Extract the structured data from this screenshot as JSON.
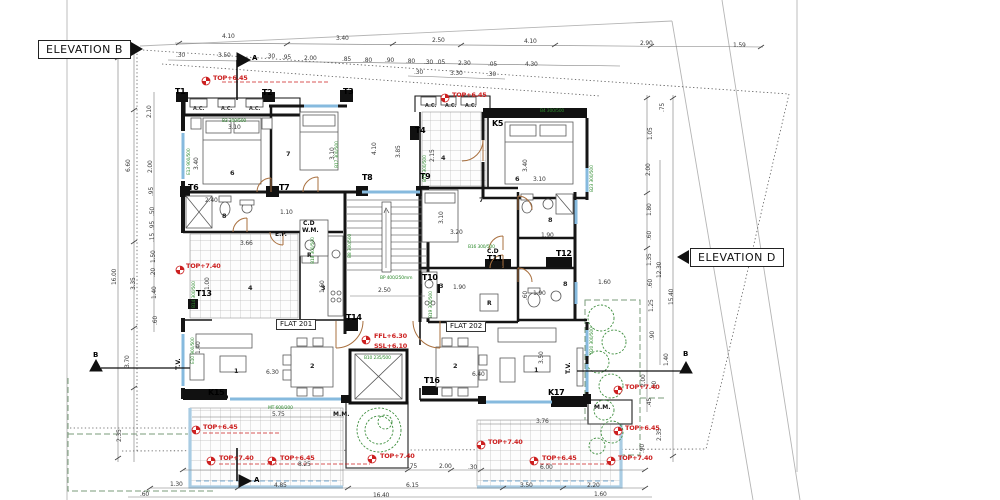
{
  "elevations": {
    "b": "ELEVATION B",
    "d": "ELEVATION D"
  },
  "label_groups": [
    {
      "name": "dim",
      "cls": "dim",
      "items": [
        {
          "t": "4.10",
          "x": 222,
          "y": 34
        },
        {
          "t": "3.40",
          "x": 336,
          "y": 36
        },
        {
          "t": "2.50",
          "x": 432,
          "y": 38
        },
        {
          "t": "4.10",
          "x": 524,
          "y": 39
        },
        {
          "t": "2.90",
          "x": 640,
          "y": 41
        },
        {
          "t": "1.59",
          "x": 733,
          "y": 43
        },
        {
          "t": ".30",
          "x": 176,
          "y": 53
        },
        {
          "t": "3.50",
          "x": 218,
          "y": 53
        },
        {
          "t": ".30",
          "x": 266,
          "y": 54
        },
        {
          "t": ".95",
          "x": 282,
          "y": 55
        },
        {
          "t": "2.00",
          "x": 304,
          "y": 56
        },
        {
          "t": ".85",
          "x": 342,
          "y": 57
        },
        {
          "t": ".80",
          "x": 363,
          "y": 58
        },
        {
          "t": ".90",
          "x": 385,
          "y": 58
        },
        {
          "t": ".80",
          "x": 406,
          "y": 59
        },
        {
          "t": ".30",
          "x": 424,
          "y": 60
        },
        {
          "t": ".05",
          "x": 436,
          "y": 60
        },
        {
          "t": "2.30",
          "x": 458,
          "y": 61
        },
        {
          "t": ".05",
          "x": 488,
          "y": 62
        },
        {
          "t": "4.30",
          "x": 525,
          "y": 62
        },
        {
          "t": ".30",
          "x": 414,
          "y": 70
        },
        {
          "t": "3.30",
          "x": 450,
          "y": 71
        },
        {
          "t": ".30",
          "x": 487,
          "y": 72
        },
        {
          "t": "16.00",
          "x": 112,
          "y": 285,
          "r": -90
        },
        {
          "t": "6.60",
          "x": 126,
          "y": 172,
          "r": -90
        },
        {
          "t": "3.35",
          "x": 131,
          "y": 290,
          "r": -90
        },
        {
          "t": "3.70",
          "x": 125,
          "y": 368,
          "r": -90
        },
        {
          "t": "2.35",
          "x": 117,
          "y": 442,
          "r": -90
        },
        {
          "t": "2.10",
          "x": 147,
          "y": 118,
          "r": -90
        },
        {
          "t": "2.00",
          "x": 148,
          "y": 173,
          "r": -90
        },
        {
          "t": ".95",
          "x": 149,
          "y": 196,
          "r": -90
        },
        {
          "t": ".50",
          "x": 150,
          "y": 216,
          "r": -90
        },
        {
          "t": ".95",
          "x": 150,
          "y": 230,
          "r": -90
        },
        {
          "t": ".15",
          "x": 150,
          "y": 242,
          "r": -90
        },
        {
          "t": "1.50",
          "x": 151,
          "y": 263,
          "r": -90
        },
        {
          "t": ".20",
          "x": 151,
          "y": 277,
          "r": -90
        },
        {
          "t": "1.40",
          "x": 152,
          "y": 299,
          "r": -90
        },
        {
          "t": ".60",
          "x": 153,
          "y": 325,
          "r": -90
        },
        {
          "t": ".75",
          "x": 660,
          "y": 112,
          "r": -90
        },
        {
          "t": "1.05",
          "x": 648,
          "y": 140,
          "r": -90
        },
        {
          "t": "2.00",
          "x": 646,
          "y": 176,
          "r": -90
        },
        {
          "t": "1.80",
          "x": 647,
          "y": 216,
          "r": -90
        },
        {
          "t": ".60",
          "x": 647,
          "y": 240,
          "r": -90
        },
        {
          "t": "1.35",
          "x": 647,
          "y": 266,
          "r": -90
        },
        {
          "t": "12.30",
          "x": 657,
          "y": 278,
          "r": -90
        },
        {
          "t": ".60",
          "x": 648,
          "y": 288,
          "r": -90
        },
        {
          "t": "1.25",
          "x": 649,
          "y": 312,
          "r": -90
        },
        {
          "t": "15.40",
          "x": 669,
          "y": 305,
          "r": -90
        },
        {
          "t": ".90",
          "x": 650,
          "y": 340,
          "r": -90
        },
        {
          "t": "1.40",
          "x": 664,
          "y": 366,
          "r": -90
        },
        {
          "t": "2.00",
          "x": 641,
          "y": 387,
          "r": -90
        },
        {
          "t": ".60",
          "x": 652,
          "y": 390,
          "r": -90
        },
        {
          "t": ".45",
          "x": 647,
          "y": 407,
          "r": -90
        },
        {
          "t": "2.35",
          "x": 657,
          "y": 441,
          "r": -90
        },
        {
          "t": ".90",
          "x": 640,
          "y": 453,
          "r": -90
        },
        {
          "t": "5.75",
          "x": 272,
          "y": 412
        },
        {
          "t": "3.76",
          "x": 536,
          "y": 419
        },
        {
          "t": "8.25",
          "x": 298,
          "y": 462
        },
        {
          "t": ".75",
          "x": 408,
          "y": 464
        },
        {
          "t": "2.00",
          "x": 439,
          "y": 464
        },
        {
          "t": ".30",
          "x": 468,
          "y": 465
        },
        {
          "t": "6.00",
          "x": 540,
          "y": 465
        },
        {
          "t": "1.30",
          "x": 170,
          "y": 482
        },
        {
          "t": "4.85",
          "x": 274,
          "y": 483
        },
        {
          "t": "6.15",
          "x": 406,
          "y": 483
        },
        {
          "t": "3.50",
          "x": 520,
          "y": 483
        },
        {
          "t": "2.20",
          "x": 587,
          "y": 483
        },
        {
          "t": ".60",
          "x": 140,
          "y": 492
        },
        {
          "t": "16.40",
          "x": 373,
          "y": 493
        },
        {
          "t": "1.60",
          "x": 594,
          "y": 492
        },
        {
          "t": "3.10",
          "x": 228,
          "y": 125
        },
        {
          "t": "3.40",
          "x": 194,
          "y": 170,
          "r": -90
        },
        {
          "t": "2.40",
          "x": 205,
          "y": 198
        },
        {
          "t": "1.10",
          "x": 280,
          "y": 210
        },
        {
          "t": "3.66",
          "x": 240,
          "y": 241
        },
        {
          "t": "1.00",
          "x": 205,
          "y": 290,
          "r": -90
        },
        {
          "t": "1.60",
          "x": 320,
          "y": 293,
          "r": -90
        },
        {
          "t": "3.10",
          "x": 330,
          "y": 160,
          "r": -90
        },
        {
          "t": "2.50",
          "x": 378,
          "y": 288
        },
        {
          "t": "4.10",
          "x": 372,
          "y": 155,
          "r": -90
        },
        {
          "t": "3.85",
          "x": 396,
          "y": 158,
          "r": -90
        },
        {
          "t": "2.15",
          "x": 430,
          "y": 162,
          "r": -90
        },
        {
          "t": "3.40",
          "x": 523,
          "y": 172,
          "r": -90
        },
        {
          "t": "3.10",
          "x": 533,
          "y": 177
        },
        {
          "t": "3.10",
          "x": 439,
          "y": 224,
          "r": -90
        },
        {
          "t": "3.20",
          "x": 450,
          "y": 230
        },
        {
          "t": "1.90",
          "x": 541,
          "y": 233
        },
        {
          "t": "1.90",
          "x": 533,
          "y": 291
        },
        {
          "t": "1.90",
          "x": 453,
          "y": 285
        },
        {
          "t": ".60",
          "x": 523,
          "y": 300,
          "r": -90
        },
        {
          "t": "1.60",
          "x": 598,
          "y": 280
        },
        {
          "t": "6.30",
          "x": 266,
          "y": 370
        },
        {
          "t": "6.40",
          "x": 472,
          "y": 372
        },
        {
          "t": "3.50",
          "x": 539,
          "y": 364,
          "r": -90
        },
        {
          "t": "1.40",
          "x": 196,
          "y": 354,
          "r": -90
        }
      ]
    },
    {
      "name": "wall-tag",
      "cls": "tag",
      "items": [
        {
          "t": "T1",
          "x": 175,
          "y": 88
        },
        {
          "t": "T2",
          "x": 262,
          "y": 89
        },
        {
          "t": "T3",
          "x": 343,
          "y": 88
        },
        {
          "t": "T4",
          "x": 415,
          "y": 127
        },
        {
          "t": "K5",
          "x": 492,
          "y": 120
        },
        {
          "t": "T6",
          "x": 188,
          "y": 184
        },
        {
          "t": "T7",
          "x": 279,
          "y": 184
        },
        {
          "t": "T8",
          "x": 362,
          "y": 174
        },
        {
          "t": "T9",
          "x": 420,
          "y": 173
        },
        {
          "t": "T10",
          "x": 422,
          "y": 274
        },
        {
          "t": "T11",
          "x": 487,
          "y": 255
        },
        {
          "t": "T12",
          "x": 556,
          "y": 250
        },
        {
          "t": "T13",
          "x": 196,
          "y": 290
        },
        {
          "t": "T14",
          "x": 346,
          "y": 314
        },
        {
          "t": "T16",
          "x": 424,
          "y": 377
        },
        {
          "t": "K15",
          "x": 208,
          "y": 389
        },
        {
          "t": "K17",
          "x": 548,
          "y": 389
        }
      ]
    },
    {
      "name": "room-number",
      "cls": "room",
      "items": [
        {
          "t": "6",
          "x": 230,
          "y": 170
        },
        {
          "t": "7",
          "x": 286,
          "y": 151
        },
        {
          "t": "8",
          "x": 222,
          "y": 213
        },
        {
          "t": "4",
          "x": 248,
          "y": 285
        },
        {
          "t": "3",
          "x": 321,
          "y": 285
        },
        {
          "t": "1",
          "x": 234,
          "y": 368
        },
        {
          "t": "2",
          "x": 310,
          "y": 363
        },
        {
          "t": "4",
          "x": 441,
          "y": 155
        },
        {
          "t": "6",
          "x": 515,
          "y": 176
        },
        {
          "t": "7",
          "x": 479,
          "y": 197
        },
        {
          "t": "8",
          "x": 548,
          "y": 217
        },
        {
          "t": "8",
          "x": 563,
          "y": 281
        },
        {
          "t": "3",
          "x": 439,
          "y": 283
        },
        {
          "t": "2",
          "x": 453,
          "y": 363
        },
        {
          "t": "1",
          "x": 534,
          "y": 367
        }
      ]
    },
    {
      "name": "level-annotation",
      "cls": "red",
      "items": [
        {
          "t": "TOP+6.45",
          "x": 213,
          "y": 75
        },
        {
          "t": "TOP+6.45",
          "x": 452,
          "y": 92
        },
        {
          "t": "TOP+7.40",
          "x": 186,
          "y": 263
        },
        {
          "t": "FFL+6.30",
          "x": 374,
          "y": 333
        },
        {
          "t": "SSL+6.10",
          "x": 374,
          "y": 343
        },
        {
          "t": "TOP+6.45",
          "x": 203,
          "y": 424
        },
        {
          "t": "TOP+7.40",
          "x": 219,
          "y": 455
        },
        {
          "t": "TOP+6.45",
          "x": 280,
          "y": 455
        },
        {
          "t": "TOP+7.40",
          "x": 380,
          "y": 453
        },
        {
          "t": "TOP+7.40",
          "x": 488,
          "y": 439
        },
        {
          "t": "TOP+6.45",
          "x": 542,
          "y": 455
        },
        {
          "t": "TOP+7.40",
          "x": 618,
          "y": 455
        },
        {
          "t": "TOP+6.45",
          "x": 625,
          "y": 425
        },
        {
          "t": "TOP+7.40",
          "x": 625,
          "y": 384
        }
      ]
    },
    {
      "name": "ac-unit-label",
      "cls": "ac",
      "items": [
        {
          "t": "A.C.",
          "x": 193,
          "y": 107
        },
        {
          "t": "A.C.",
          "x": 221,
          "y": 107
        },
        {
          "t": "A.C.",
          "x": 249,
          "y": 107
        },
        {
          "t": "A.C.",
          "x": 425,
          "y": 104
        },
        {
          "t": "A.C.",
          "x": 445,
          "y": 104
        },
        {
          "t": "A.C.",
          "x": 465,
          "y": 104
        }
      ]
    },
    {
      "name": "utility-label",
      "cls": "misc",
      "items": [
        {
          "t": "E.P.",
          "x": 275,
          "y": 232
        },
        {
          "t": "E.P.",
          "x": 497,
          "y": 263
        },
        {
          "t": "C.D",
          "x": 303,
          "y": 221
        },
        {
          "t": "W.M.",
          "x": 302,
          "y": 228
        },
        {
          "t": "C.D",
          "x": 487,
          "y": 249
        },
        {
          "t": "M.M.",
          "x": 333,
          "y": 412
        },
        {
          "t": "M.M.",
          "x": 594,
          "y": 405
        },
        {
          "t": "R",
          "x": 307,
          "y": 253
        },
        {
          "t": "R",
          "x": 487,
          "y": 301
        },
        {
          "t": "T.V.",
          "x": 176,
          "y": 370,
          "r": -90
        },
        {
          "t": "T.V.",
          "x": 566,
          "y": 374,
          "r": -90
        }
      ]
    },
    {
      "name": "window-code",
      "cls": "green",
      "items": [
        {
          "t": "B3 300/500",
          "x": 222,
          "y": 120
        },
        {
          "t": "E13 900/500",
          "x": 188,
          "y": 175,
          "r": -90
        },
        {
          "t": "B17 300/500",
          "x": 336,
          "y": 168,
          "r": -90
        },
        {
          "t": "B18 300/500",
          "x": 312,
          "y": 264,
          "r": -90
        },
        {
          "t": "B14 300/500",
          "x": 193,
          "y": 308,
          "r": -90
        },
        {
          "t": "E10 900/500",
          "x": 192,
          "y": 364,
          "r": -90
        },
        {
          "t": "MT 600/200",
          "x": 268,
          "y": 407
        },
        {
          "t": "B8 300/500",
          "x": 349,
          "y": 258,
          "r": -90
        },
        {
          "t": "B4 300/500",
          "x": 540,
          "y": 110
        },
        {
          "t": "B23 300/500",
          "x": 591,
          "y": 192,
          "r": -90
        },
        {
          "t": "B20 300/500",
          "x": 591,
          "y": 354,
          "r": -90
        },
        {
          "t": "B15 300/500",
          "x": 424,
          "y": 182,
          "r": -90
        },
        {
          "t": "B16 300/500",
          "x": 468,
          "y": 246
        },
        {
          "t": "B10 235/500",
          "x": 364,
          "y": 357
        },
        {
          "t": "BP 400/250mm",
          "x": 380,
          "y": 277
        },
        {
          "t": "B19 300/500",
          "x": 430,
          "y": 318,
          "r": -90
        }
      ]
    },
    {
      "name": "flat-label",
      "cls": "boxlbl",
      "items": [
        {
          "t": "FLAT 201",
          "x": 276,
          "y": 319
        },
        {
          "t": "FLAT 202",
          "x": 446,
          "y": 321
        }
      ]
    },
    {
      "name": "section-letter",
      "cls": "sec",
      "items": [
        {
          "t": "A",
          "x": 252,
          "y": 55
        },
        {
          "t": "A",
          "x": 254,
          "y": 477
        },
        {
          "t": "B",
          "x": 93,
          "y": 352
        },
        {
          "t": "B",
          "x": 683,
          "y": 351
        }
      ]
    }
  ]
}
